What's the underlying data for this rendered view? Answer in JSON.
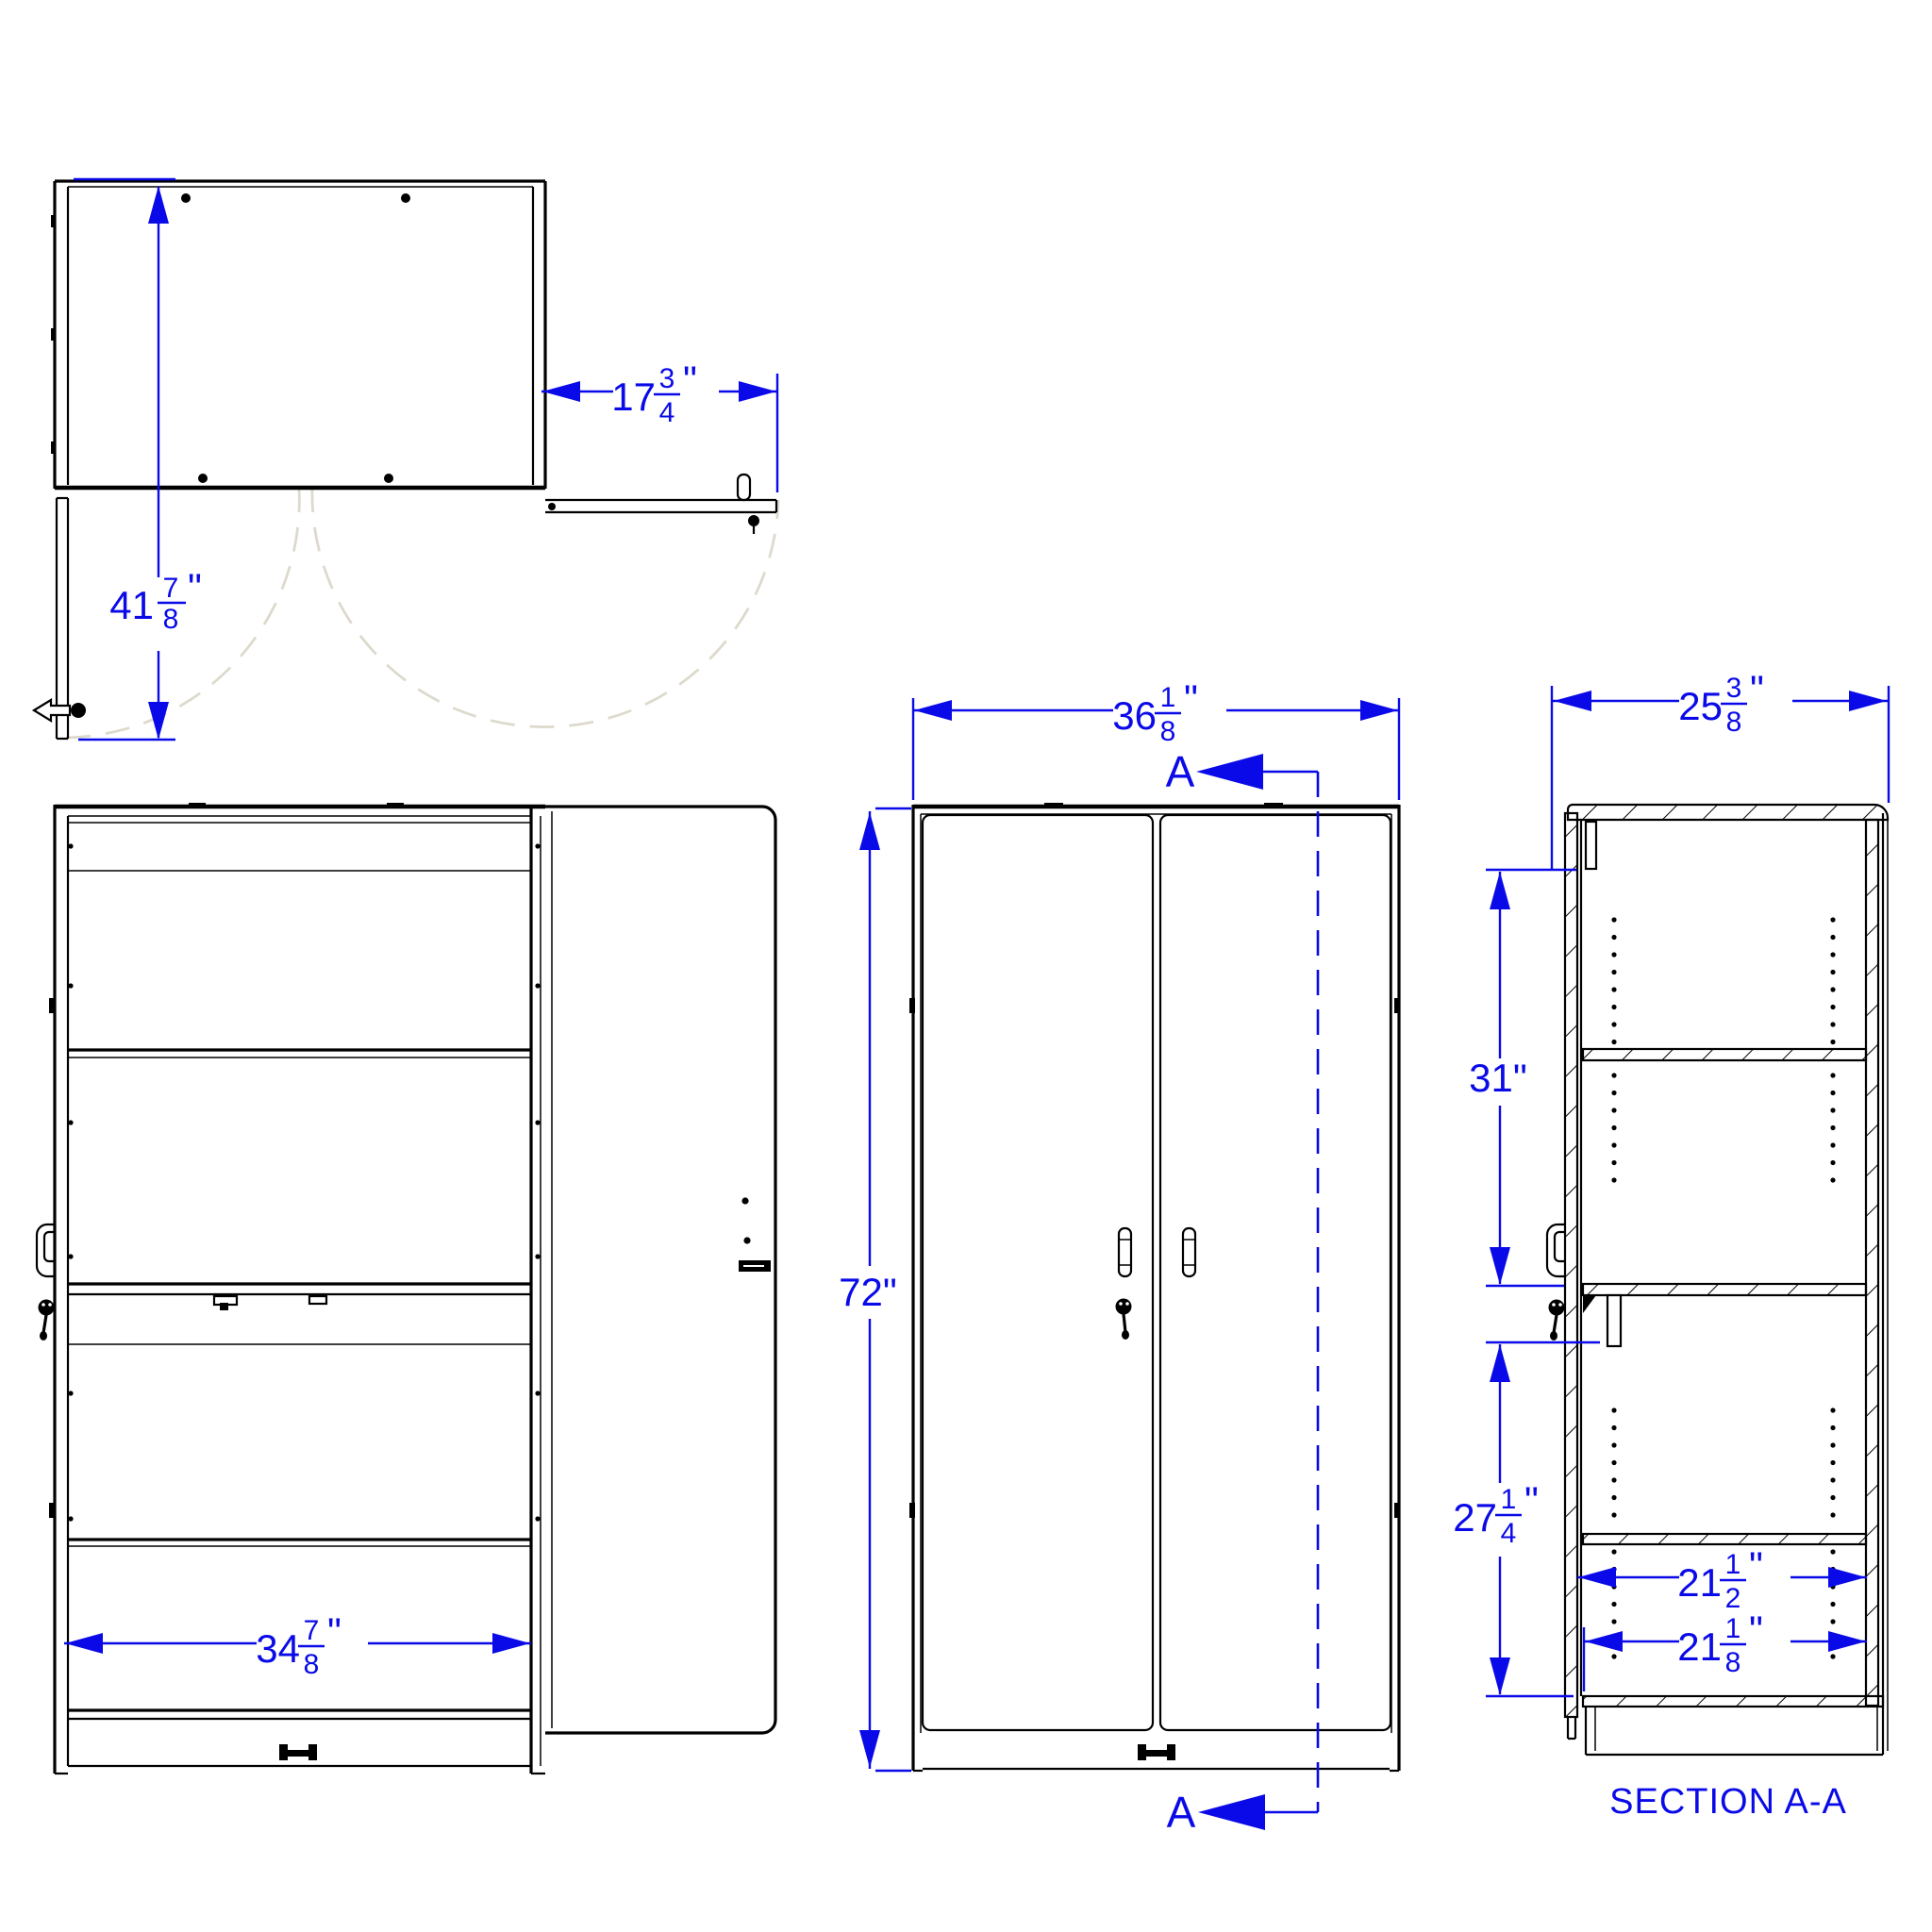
{
  "drawing": {
    "type": "cad-cabinet-drawing",
    "background_color": "#ffffff",
    "line_color": "#000000",
    "dimension_color": "#0a0ae8",
    "swing_arc_color": "#dddacd",
    "section_label": "SECTION A-A",
    "section_marker": "A",
    "views": {
      "plan": "top view, both doors open",
      "front_open": "front view, left door open",
      "front_closed": "front view, doors closed",
      "section": "section A-A"
    },
    "dims": {
      "plan_height": {
        "label": "41 7/8\"",
        "whole": "41",
        "num": "7",
        "den": "8",
        "unit": "\""
      },
      "door_width": {
        "label": "17 3/4\"",
        "whole": "17",
        "num": "3",
        "den": "4",
        "unit": "\""
      },
      "interior_width": {
        "label": "34 7/8\"",
        "whole": "34",
        "num": "7",
        "den": "8",
        "unit": "\""
      },
      "overall_width": {
        "label": "36 1/8\"",
        "whole": "36",
        "num": "1",
        "den": "8",
        "unit": "\""
      },
      "overall_height": {
        "label": "72\"",
        "whole": "72",
        "unit": "\""
      },
      "overall_depth": {
        "label": "25 3/8\"",
        "whole": "25",
        "num": "3",
        "den": "8",
        "unit": "\""
      },
      "upper_section_height": {
        "label": "31\"",
        "whole": "31",
        "unit": "\""
      },
      "lower_section_height": {
        "label": "27 1/4\"",
        "whole": "27",
        "num": "1",
        "den": "4",
        "unit": "\""
      },
      "upper_shelf_depth": {
        "label": "21 1/2\"",
        "whole": "21",
        "num": "1",
        "den": "2",
        "unit": "\""
      },
      "lower_shelf_depth": {
        "label": "21 1/8\"",
        "whole": "21",
        "num": "1",
        "den": "8",
        "unit": "\""
      }
    }
  }
}
